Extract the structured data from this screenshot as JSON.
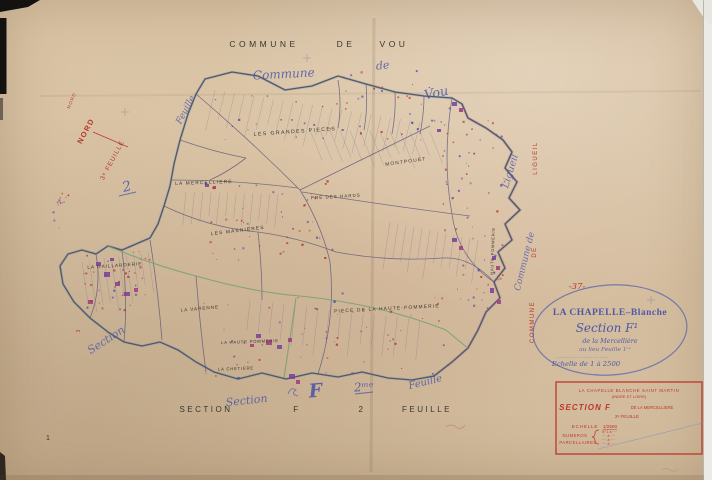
{
  "printed": {
    "top_title_words": [
      "COMMUNE",
      "DE",
      "VOU"
    ],
    "bottom_title_words": [
      "SECTION",
      "F",
      "2",
      "FEUILLE"
    ],
    "page_number": "1"
  },
  "red_annotations": {
    "nord_small": "NORD",
    "nord_large": "NORD",
    "feuille3": "3ᵉ FEUILLE",
    "commune_vertical": [
      "LIGUEIL",
      "DE",
      "COMMUNE"
    ],
    "section3": "3",
    "sheet_number": "-37-"
  },
  "script_annotations": {
    "commune": "Commune",
    "de": "de",
    "vou": "Vou",
    "feuille_nw": "Feuille",
    "two_nw": "2",
    "ligueil": "Ligueil",
    "commune_de_e": "Commune de",
    "section_sw": "Section",
    "section_bottom": "Section",
    "f_big": "F",
    "two_bottom": "2ᵐᵉ",
    "feuille_se": "Feuille"
  },
  "place_labels": [
    {
      "text": "LES GRANDES PIECES"
    },
    {
      "text": "MONTPOUET"
    },
    {
      "text": "LA MERCELLIERE"
    },
    {
      "text": "LES MASNIERES"
    },
    {
      "text": "PRE DES HARDS"
    },
    {
      "text": "LA GAILLARDERIE"
    },
    {
      "text": "LA VARENNE"
    },
    {
      "text": "PIECE DE LA HAUTE-POMMERIE"
    },
    {
      "text": "LA HAUTE POMMERIE"
    },
    {
      "text": "LA CHETIERE"
    },
    {
      "text": "HAUTE POMMERIE"
    }
  ],
  "stamp": {
    "line1": "LA CHAPELLE–Blanche",
    "line2": "Section F¹",
    "line3": "de la Mercellière",
    "line4": "au lieu Feuille 1ʳᵉ",
    "line5": "..............................",
    "line6": "Echelle de 1 à 2500"
  },
  "legend_box": {
    "line1": "LA CHAPELLE BLANCHE SAINT MARTIN",
    "line2": "(INDRE ET LOIRE)",
    "section": "SECTION F",
    "section_suffix": "DE LA MERCELLIERE",
    "feuille": "2ᵉ FEUILLE",
    "echelle_label": "ECHELLE",
    "echelle_value": "1/2500",
    "numeros_label1": "NUMEROS",
    "numeros_label2": "PARCELLAIRES",
    "numeros_items": [
      "N° 1 à ····",
      "···· à ····",
      "···· à ····",
      "···· à ····"
    ]
  }
}
